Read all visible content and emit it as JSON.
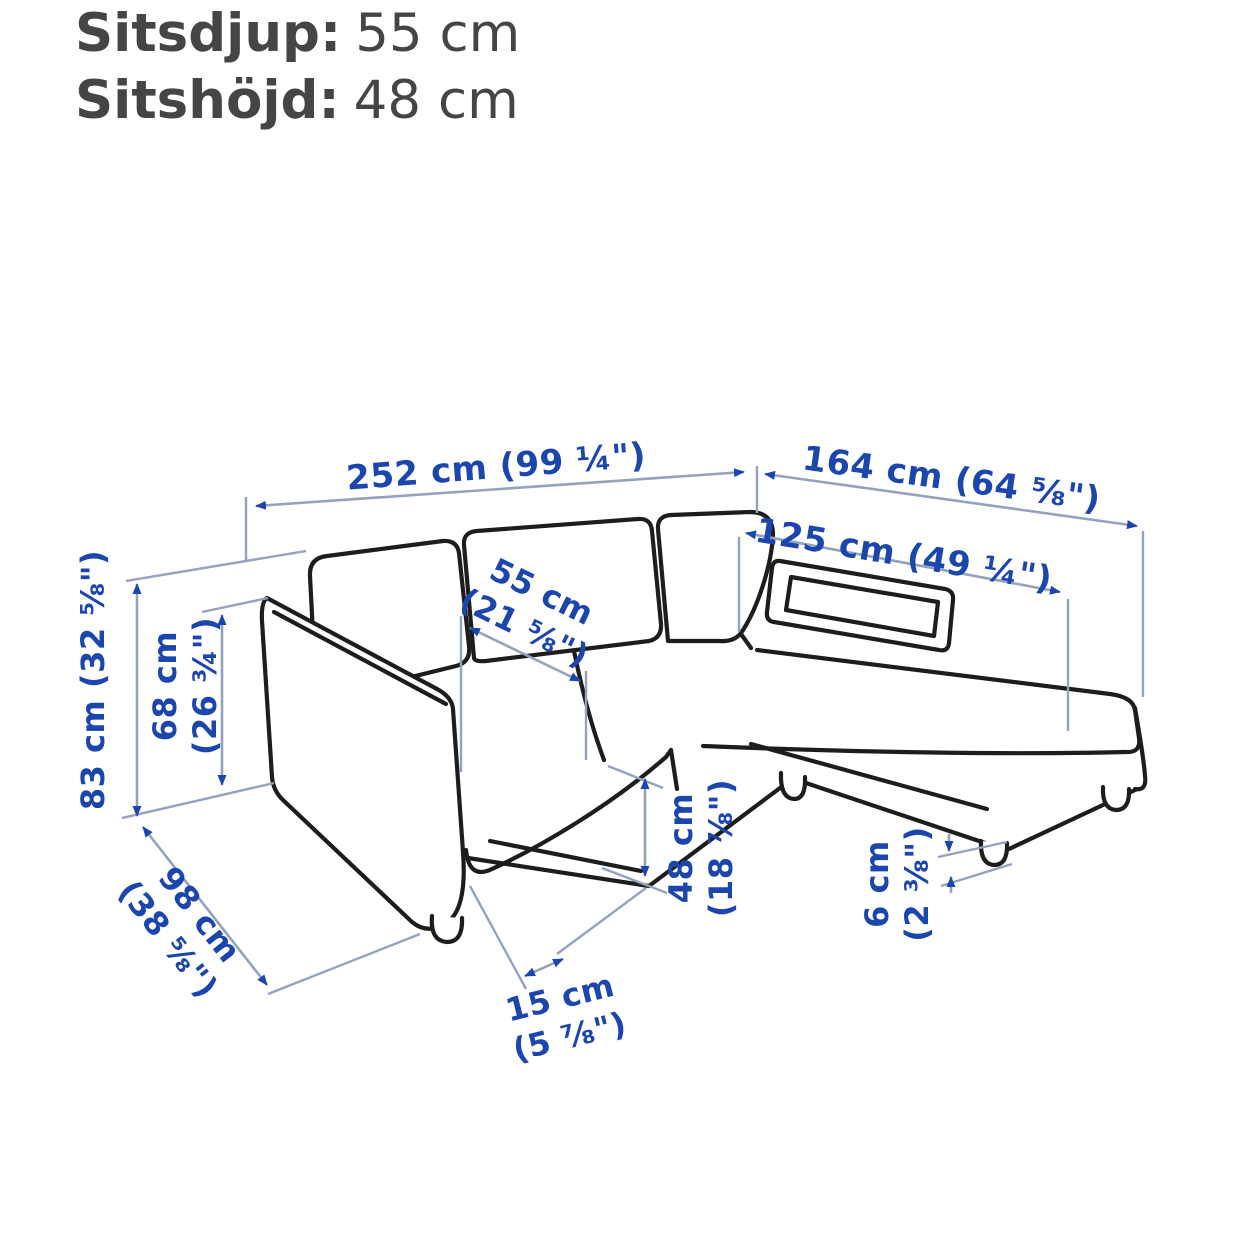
{
  "header": {
    "rows": [
      {
        "label": "Sitsdjup:",
        "value": "55 cm"
      },
      {
        "label": "Sitshöjd:",
        "value": "48 cm"
      }
    ]
  },
  "diagram": {
    "description": "Dimension line drawing of a 3-seat sofa with chaise longue, viewed in perspective",
    "dimensions": {
      "total_width": {
        "line1": "252 cm (99 ¼\")"
      },
      "total_depth": {
        "line1": "164 cm (64 ⅝\")"
      },
      "chaise_length": {
        "line1": "125 cm (49 ¼\")"
      },
      "seat_depth": {
        "line1": "55 cm",
        "line2": "(21 ⅝\")"
      },
      "total_height": {
        "line1": "83 cm (32 ⅝\")"
      },
      "armrest_height": {
        "line1": "68 cm",
        "line2": "(26 ¾\")"
      },
      "sofa_depth": {
        "line1": "98 cm",
        "line2": "(38 ⅝\")"
      },
      "seat_height": {
        "line1": "48 cm",
        "line2": "(18 ⅞\")"
      },
      "leg_setback": {
        "line1": "15 cm",
        "line2": "(5 ⅞\")"
      },
      "floor_clearance": {
        "line1": "6 cm",
        "line2": "(2 ⅜\")"
      }
    },
    "colors": {
      "dimension_text": "#1b46ae",
      "dimension_line": "#93a2bd",
      "outline": "#1d1d1d",
      "header_text": "#454545",
      "background": "#ffffff"
    }
  }
}
